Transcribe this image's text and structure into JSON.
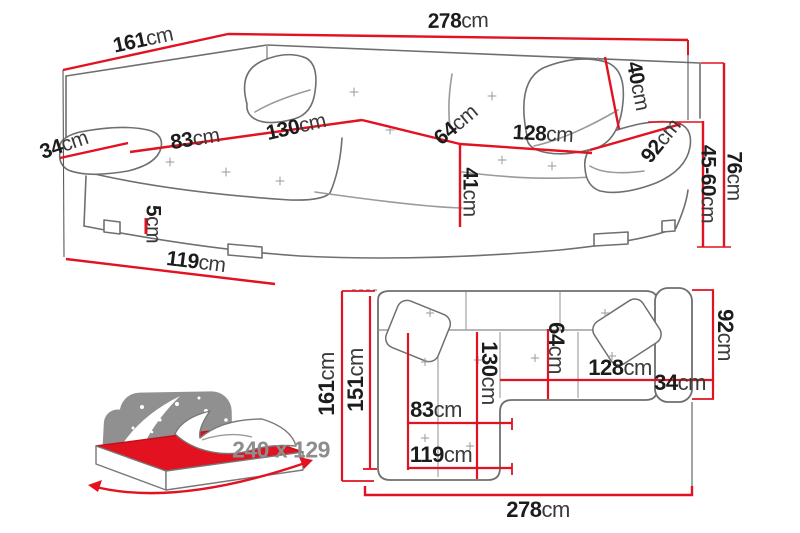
{
  "colors": {
    "dimension_red": "#e21220",
    "outline_gray": "#6f6f6f",
    "text_black": "#1c1c1c",
    "muted_gray": "#8d8d8d"
  },
  "perspective_view": {
    "side_depth": {
      "value": "161",
      "unit": "cm"
    },
    "total_width": {
      "value": "278",
      "unit": "cm"
    },
    "armrest_front_width": {
      "value": "34",
      "unit": "cm"
    },
    "chaise_seat_width": {
      "value": "83",
      "unit": "cm"
    },
    "chaise_seat_length": {
      "value": "130",
      "unit": "cm"
    },
    "seat_depth": {
      "value": "64",
      "unit": "cm"
    },
    "backrest_height": {
      "value": "40",
      "unit": "cm"
    },
    "seat_front_width": {
      "value": "128",
      "unit": "cm"
    },
    "armrest_length": {
      "value": "92",
      "unit": "cm"
    },
    "seat_height": {
      "value": "41",
      "unit": "cm"
    },
    "armrest_height_range": {
      "value": "45-60",
      "unit": "cm"
    },
    "total_height": {
      "value": "76",
      "unit": "cm"
    },
    "leg_height": {
      "value": "5",
      "unit": "cm"
    },
    "chaise_outer_length": {
      "value": "119",
      "unit": "cm"
    }
  },
  "top_view": {
    "depth_total": {
      "value": "161",
      "unit": "cm"
    },
    "depth_inner": {
      "value": "151",
      "unit": "cm"
    },
    "chaise_length": {
      "value": "130",
      "unit": "cm"
    },
    "seat_depth": {
      "value": "64",
      "unit": "cm"
    },
    "seat_width": {
      "value": "128",
      "unit": "cm"
    },
    "armrest_width": {
      "value": "34",
      "unit": "cm"
    },
    "armrest_depth": {
      "value": "92",
      "unit": "cm"
    },
    "chaise_seat_width": {
      "value": "83",
      "unit": "cm"
    },
    "chaise_outer_length": {
      "value": "119",
      "unit": "cm"
    },
    "total_width": {
      "value": "278",
      "unit": "cm"
    }
  },
  "sleeping_area": {
    "dimensions_label": "240 x 129"
  }
}
